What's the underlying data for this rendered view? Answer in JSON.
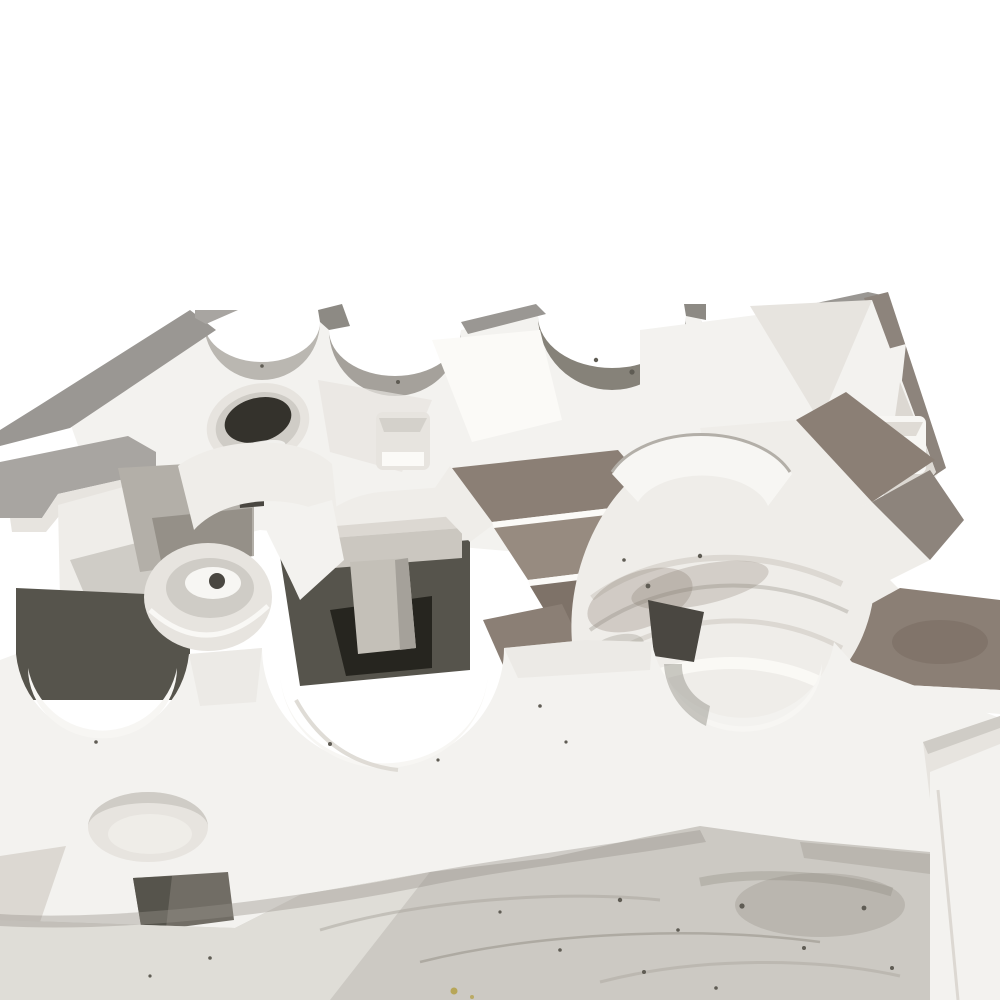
{
  "meta": {
    "domain": "natural-image",
    "subject": "Large white-painted metal casting mold half photographed three-quarter from above",
    "environment": "dusty concrete workshop floor, plain white backdrop",
    "object_features": [
      "semicircular bearing bores along rear top edge",
      "grey-brown stepped parting-line flanges",
      "large half-cylinder bore saddle with ribs",
      "rectangular core pockets",
      "round cored hole with dark opening",
      "bowl-shaped boss with small hole",
      "elliptical recess on front wall",
      "arched openings along front wall",
      "white powder dust and dark speckles"
    ]
  },
  "palette": {
    "bg": "#ffffff",
    "white_face": "#f3f2ef",
    "white_bright": "#fbfaf7",
    "white_soft": "#efede9",
    "white_band": "#f7f6f3",
    "white_shade": "#e7e4df",
    "white_shade2": "#dcd8d2",
    "grey_light": "#cfccc6",
    "grey_mid": "#b3afa8",
    "grey_rim": "#9a9793",
    "grey_rim_dark": "#8d8a84",
    "steel": "#a8a5a1",
    "taupe": "#8b7f75",
    "taupe_light": "#978b80",
    "taupe_dark": "#7e7268",
    "bar_brown": "#8d847c",
    "lune1": "#bab7b1",
    "lune2": "#a5a19b",
    "lune3": "#868279",
    "lune4": "#9d9993",
    "cavity": "#56544c",
    "cavity_deep": "#26251f",
    "hole_dark": "#34322c",
    "slot_dark": "#4a4741",
    "notch_dark": "#716d65",
    "pillar": "#cbc7c0",
    "pillar_stem": "#c4c0b8",
    "pillar_shade": "#a5a19a",
    "floor": "#ccc9c3",
    "floor_light": "#e2e0da",
    "smudge": "#a8a49b",
    "smudge_dark": "#8f8b82",
    "shadow": "#98948b",
    "speck": "#5f5c54",
    "yellow_speck": "#b5a24d"
  }
}
